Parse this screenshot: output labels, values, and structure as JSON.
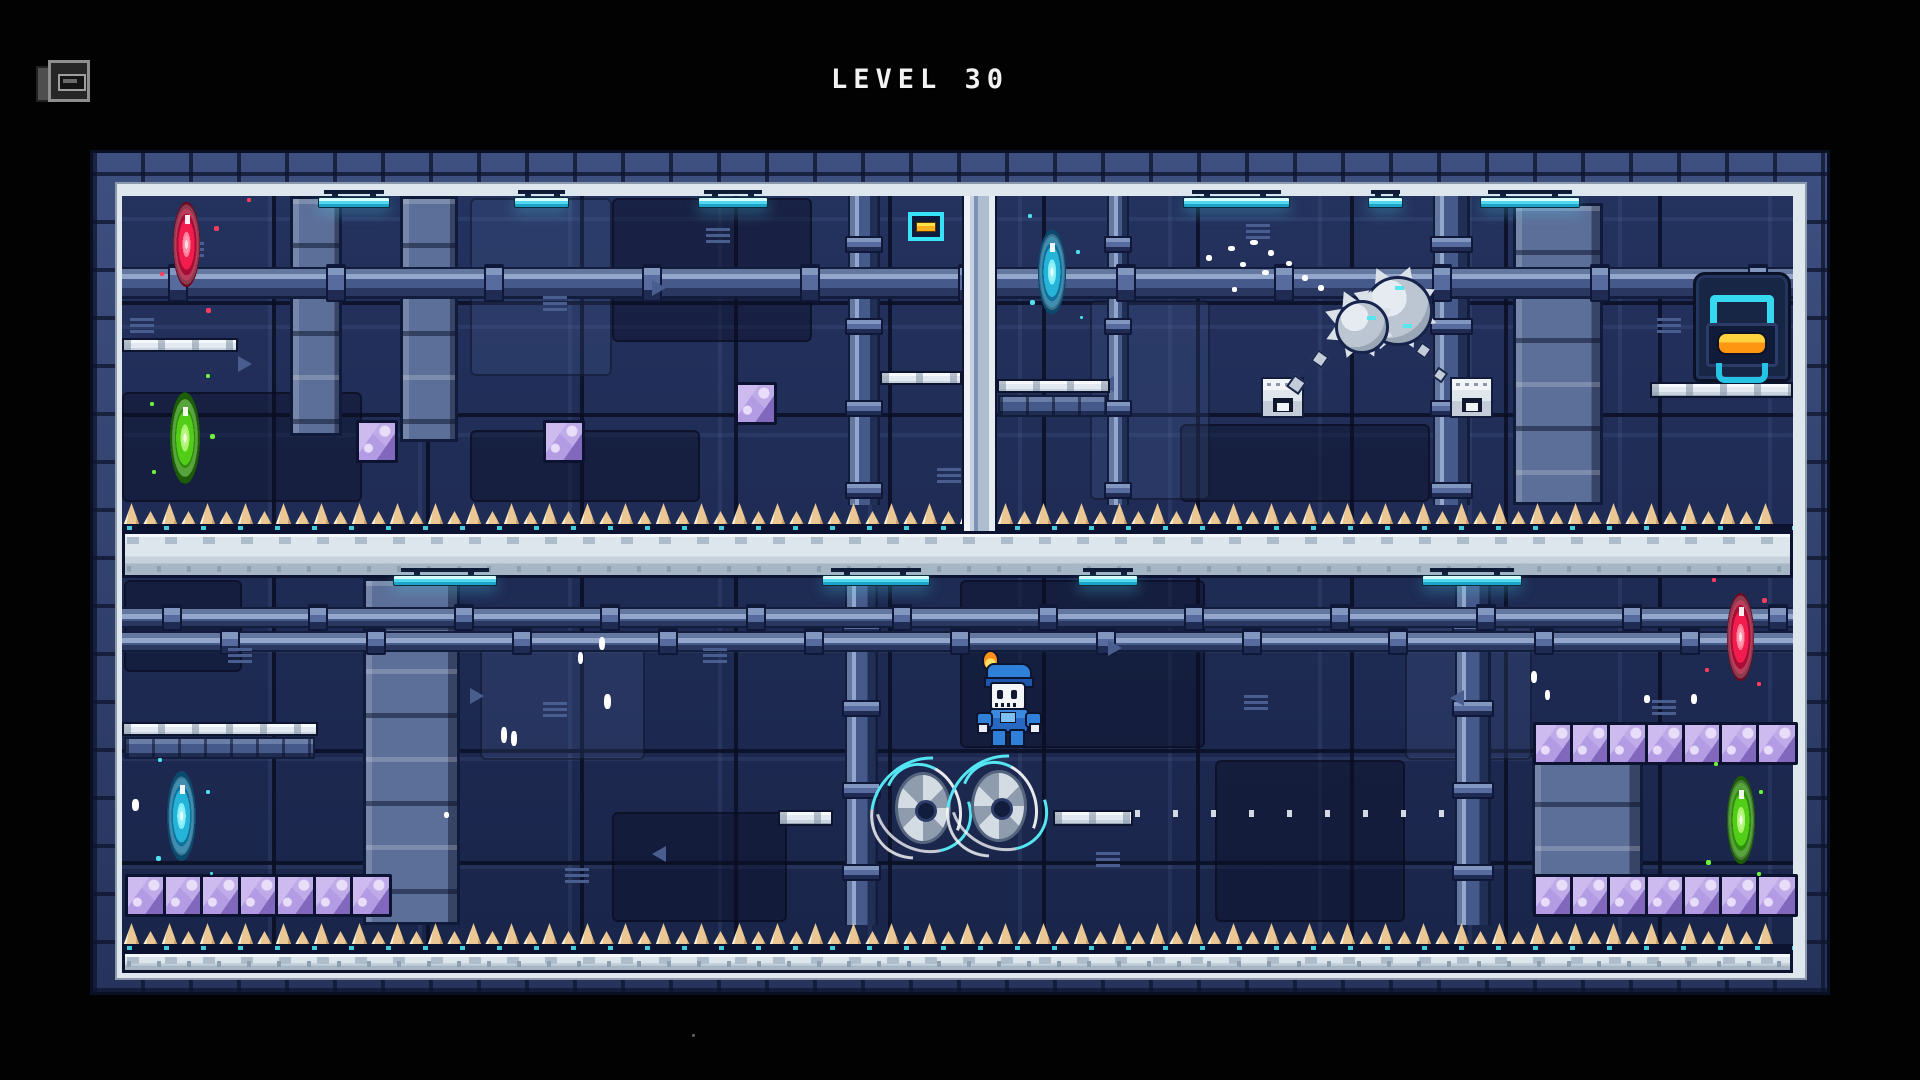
{
  "hud": {
    "level_label": "LEVEL 30",
    "level_number": "30",
    "menu_icon": "camera-icon",
    "title_color": "#f2f2f2"
  },
  "palette": {
    "background": "#020203",
    "wall": "#1e2b55",
    "frame_band": "#2c3a64",
    "platform_white": "#dfe7ee",
    "spike_tan": "#eac793",
    "crystal_purple": "#ab92da",
    "lamp_cyan": "#52d8ee",
    "door_accent_cyan": "#35d8ee",
    "door_button_orange": "#ff9612"
  },
  "portal_colors": {
    "red": {
      "core": "#ffd9e0",
      "light": "#ff7d97",
      "mid": "#f21c4e",
      "dark": "#a80e35",
      "edge": "#6e0a22"
    },
    "green": {
      "core": "#f2ffd8",
      "light": "#a9f26a",
      "mid": "#53ce18",
      "dark": "#2f8e0c",
      "edge": "#1c5c06"
    },
    "cyan": {
      "core": "#e2fcff",
      "light": "#7deef8",
      "mid": "#25b4d8",
      "dark": "#10719c",
      "edge": "#0a4a6e"
    }
  },
  "frame": {
    "x": 90,
    "y": 150,
    "w": 1740,
    "h": 845,
    "inner": {
      "x": 122,
      "y": 196,
      "w": 1671,
      "h": 777
    }
  },
  "entities": [
    {
      "t": "panelD",
      "n": "wall-panel-dark",
      "x": 122,
      "y": 392,
      "w": 240,
      "h": 110
    },
    {
      "t": "panelD",
      "n": "wall-panel-dark",
      "x": 612,
      "y": 198,
      "w": 200,
      "h": 144
    },
    {
      "t": "panelD",
      "n": "wall-panel-dark",
      "x": 1180,
      "y": 424,
      "w": 250,
      "h": 78
    },
    {
      "t": "panelD",
      "n": "wall-panel-dark",
      "x": 470,
      "y": 430,
      "w": 230,
      "h": 72
    },
    {
      "t": "panelD",
      "n": "wall-panel-dark",
      "x": 960,
      "y": 580,
      "w": 245,
      "h": 168
    },
    {
      "t": "panelD",
      "n": "wall-panel-dark",
      "x": 1215,
      "y": 760,
      "w": 190,
      "h": 162
    },
    {
      "t": "panelD",
      "n": "wall-panel-dark",
      "x": 612,
      "y": 812,
      "w": 175,
      "h": 110
    },
    {
      "t": "panelD",
      "n": "wall-panel-dark",
      "x": 124,
      "y": 580,
      "w": 118,
      "h": 92
    },
    {
      "t": "panelL",
      "n": "wall-panel-light",
      "x": 470,
      "y": 198,
      "w": 142,
      "h": 178
    },
    {
      "t": "panelL",
      "n": "wall-panel-light",
      "x": 1090,
      "y": 300,
      "w": 120,
      "h": 200
    },
    {
      "t": "panelL",
      "n": "wall-panel-light",
      "x": 480,
      "y": 640,
      "w": 165,
      "h": 120
    },
    {
      "t": "panelL",
      "n": "wall-panel-light",
      "x": 1405,
      "y": 620,
      "w": 127,
      "h": 140
    },
    {
      "t": "cab",
      "n": "machine-cabinet",
      "x": 290,
      "y": 196,
      "w": 52,
      "h": 240
    },
    {
      "t": "cab",
      "n": "machine-cabinet",
      "x": 400,
      "y": 196,
      "w": 58,
      "h": 246
    },
    {
      "t": "cab",
      "n": "machine-cabinet",
      "x": 1513,
      "y": 203,
      "w": 90,
      "h": 302
    },
    {
      "t": "cab",
      "n": "machine-cabinet",
      "x": 363,
      "y": 578,
      "w": 97,
      "h": 347
    },
    {
      "t": "cab",
      "n": "machine-cabinet",
      "x": 1532,
      "y": 755,
      "w": 111,
      "h": 158
    },
    {
      "t": "pipeV",
      "n": "vertical-pipe",
      "x": 848,
      "y": 196,
      "w": 32,
      "h": 309
    },
    {
      "t": "pipeV",
      "n": "vertical-pipe",
      "x": 1107,
      "y": 196,
      "w": 22,
      "h": 309
    },
    {
      "t": "pipeV",
      "n": "vertical-pipe",
      "x": 1433,
      "y": 196,
      "w": 37,
      "h": 309
    },
    {
      "t": "pipeV",
      "n": "vertical-pipe",
      "x": 845,
      "y": 578,
      "w": 33,
      "h": 347
    },
    {
      "t": "pipeV",
      "n": "vertical-pipe",
      "x": 1455,
      "y": 578,
      "w": 36,
      "h": 347
    },
    {
      "t": "pipeH",
      "n": "horizontal-pipe",
      "x": 122,
      "y": 267,
      "w": 1671,
      "h": 32,
      "step": 158,
      "off": 46
    },
    {
      "t": "pipeH",
      "n": "horizontal-pipe",
      "x": 122,
      "y": 607,
      "w": 1671,
      "h": 21,
      "step": 146,
      "off": 40
    },
    {
      "t": "pipeH",
      "n": "horizontal-pipe",
      "x": 122,
      "y": 631,
      "w": 1671,
      "h": 21,
      "step": 146,
      "off": 98
    },
    {
      "t": "vent",
      "n": "wall-vent",
      "x": 180,
      "y": 242
    },
    {
      "t": "vent",
      "n": "wall-vent",
      "x": 543,
      "y": 296
    },
    {
      "t": "vent",
      "n": "wall-vent",
      "x": 706,
      "y": 228
    },
    {
      "t": "vent",
      "n": "wall-vent",
      "x": 1246,
      "y": 224
    },
    {
      "t": "vent",
      "n": "wall-vent",
      "x": 1657,
      "y": 318
    },
    {
      "t": "vent",
      "n": "wall-vent",
      "x": 937,
      "y": 468
    },
    {
      "t": "vent",
      "n": "wall-vent",
      "x": 543,
      "y": 702
    },
    {
      "t": "vent",
      "n": "wall-vent",
      "x": 703,
      "y": 648
    },
    {
      "t": "vent",
      "n": "wall-vent",
      "x": 1244,
      "y": 695
    },
    {
      "t": "vent",
      "n": "wall-vent",
      "x": 1652,
      "y": 700
    },
    {
      "t": "vent",
      "n": "wall-vent",
      "x": 565,
      "y": 868
    },
    {
      "t": "vent",
      "n": "wall-vent",
      "x": 1096,
      "y": 852
    },
    {
      "t": "vent",
      "n": "wall-vent",
      "x": 228,
      "y": 648
    },
    {
      "t": "vent",
      "n": "wall-vent",
      "x": 130,
      "y": 318
    },
    {
      "t": "arr",
      "n": "wall-arrow",
      "x": 238,
      "y": 356,
      "d": 1
    },
    {
      "t": "arr",
      "n": "wall-arrow",
      "x": 652,
      "y": 280,
      "d": 1
    },
    {
      "t": "arr",
      "n": "wall-arrow",
      "x": 1100,
      "y": 376,
      "d": -1
    },
    {
      "t": "arr",
      "n": "wall-arrow",
      "x": 470,
      "y": 688,
      "d": 1
    },
    {
      "t": "arr",
      "n": "wall-arrow",
      "x": 652,
      "y": 846,
      "d": -1
    },
    {
      "t": "arr",
      "n": "wall-arrow",
      "x": 1108,
      "y": 640,
      "d": 1
    },
    {
      "t": "arr",
      "n": "wall-arrow",
      "x": 1450,
      "y": 690,
      "d": -1
    },
    {
      "t": "duct",
      "n": "wall-duct",
      "x": 998,
      "y": 395,
      "w": 109,
      "h": 22
    },
    {
      "t": "duct",
      "n": "wall-duct",
      "x": 124,
      "y": 737,
      "w": 191,
      "h": 22
    },
    {
      "t": "rivets",
      "n": "wall-rivet-strip",
      "x": 1135,
      "y": 810,
      "w": 322,
      "h": 7
    },
    {
      "t": "ledge",
      "n": "upper-left-ledge",
      "x": 122,
      "y": 338,
      "w": 116,
      "h": 14
    },
    {
      "t": "ledge",
      "n": "pole-left-ledge",
      "x": 880,
      "y": 371,
      "w": 82,
      "h": 14
    },
    {
      "t": "ledge",
      "n": "pole-right-ledge",
      "x": 997,
      "y": 379,
      "w": 113,
      "h": 14
    },
    {
      "t": "ledge",
      "n": "door-ledge",
      "x": 1650,
      "y": 382,
      "w": 143,
      "h": 16
    },
    {
      "t": "ledge",
      "n": "lower-left-ledge",
      "x": 122,
      "y": 722,
      "w": 196,
      "h": 14
    },
    {
      "t": "ledge",
      "n": "saw-left-platform",
      "x": 778,
      "y": 810,
      "w": 55,
      "h": 16
    },
    {
      "t": "ledge",
      "n": "saw-right-platform",
      "x": 1053,
      "y": 810,
      "w": 80,
      "h": 16
    },
    {
      "t": "beam",
      "n": "divider-beam",
      "x": 122,
      "y": 531,
      "w": 1671,
      "h": 47
    },
    {
      "t": "beam",
      "n": "floor-beam",
      "x": 122,
      "y": 951,
      "w": 1671,
      "h": 22
    },
    {
      "t": "spikes",
      "n": "upper-room-floor-spikes",
      "x": 122,
      "y": 505,
      "w": 1671
    },
    {
      "t": "spikes",
      "n": "lower-room-floor-spikes",
      "x": 122,
      "y": 925,
      "w": 1671
    },
    {
      "t": "pole",
      "n": "white-pole",
      "x": 962,
      "y": 196,
      "w": 35,
      "h": 335
    },
    {
      "t": "lamp",
      "n": "ceiling-lamp",
      "x": 318,
      "y": 190,
      "w": 72
    },
    {
      "t": "lamp",
      "n": "ceiling-lamp",
      "x": 514,
      "y": 190,
      "w": 55
    },
    {
      "t": "lamp",
      "n": "ceiling-lamp",
      "x": 698,
      "y": 190,
      "w": 70
    },
    {
      "t": "lamp",
      "n": "ceiling-lamp",
      "x": 1183,
      "y": 190,
      "w": 107
    },
    {
      "t": "lamp",
      "n": "ceiling-lamp",
      "x": 1368,
      "y": 190,
      "w": 35
    },
    {
      "t": "lamp",
      "n": "ceiling-lamp",
      "x": 1480,
      "y": 190,
      "w": 100
    },
    {
      "t": "lamp",
      "n": "ceiling-lamp",
      "x": 393,
      "y": 568,
      "w": 104
    },
    {
      "t": "lamp",
      "n": "ceiling-lamp",
      "x": 822,
      "y": 568,
      "w": 108
    },
    {
      "t": "lamp",
      "n": "ceiling-lamp",
      "x": 1078,
      "y": 568,
      "w": 60
    },
    {
      "t": "lamp",
      "n": "ceiling-lamp",
      "x": 1422,
      "y": 568,
      "w": 100
    },
    {
      "t": "sign",
      "n": "switch-sign",
      "x": 908,
      "y": 212,
      "w": 36,
      "h": 29
    },
    {
      "t": "door",
      "n": "exit-door",
      "x": 1693,
      "y": 272,
      "w": 98,
      "h": 110
    },
    {
      "t": "portal",
      "n": "portal-red-upper-left",
      "c": "red",
      "x": 171,
      "y": 196,
      "w": 31,
      "h": 97
    },
    {
      "t": "portal",
      "n": "portal-green-upper-left",
      "c": "green",
      "x": 168,
      "y": 386,
      "w": 34,
      "h": 104
    },
    {
      "t": "portal",
      "n": "portal-cyan-upper-middle",
      "c": "cyan",
      "x": 1036,
      "y": 224,
      "w": 32,
      "h": 96
    },
    {
      "t": "portal",
      "n": "portal-cyan-lower-left",
      "c": "cyan",
      "x": 165,
      "y": 765,
      "w": 33,
      "h": 102
    },
    {
      "t": "portal",
      "n": "portal-red-lower-right",
      "c": "red",
      "x": 1725,
      "y": 587,
      "w": 31,
      "h": 100
    },
    {
      "t": "portal",
      "n": "portal-green-lower-right",
      "c": "green",
      "x": 1725,
      "y": 770,
      "w": 32,
      "h": 100
    },
    {
      "t": "crystalRow",
      "n": "crystal-block",
      "x": 356,
      "y": 420,
      "count": 1,
      "step": 37.5
    },
    {
      "t": "crystalRow",
      "n": "crystal-block",
      "x": 543,
      "y": 420,
      "count": 1,
      "step": 37.5
    },
    {
      "t": "crystalRow",
      "n": "crystal-block",
      "x": 735,
      "y": 382,
      "count": 1,
      "step": 37.5
    },
    {
      "t": "crystalRow",
      "n": "crystal-row-lower-left",
      "x": 125,
      "y": 874,
      "count": 7,
      "step": 37.5
    },
    {
      "t": "crystalRow",
      "n": "crystal-row-lower-right-top",
      "x": 1533,
      "y": 722,
      "count": 7,
      "step": 37.2
    },
    {
      "t": "crystalRow",
      "n": "crystal-row-lower-right-bottom",
      "x": 1533,
      "y": 874,
      "count": 7,
      "step": 37.2
    },
    {
      "t": "disp",
      "n": "block-dispenser",
      "x": 1261,
      "y": 377,
      "w": 43,
      "h": 41
    },
    {
      "t": "disp",
      "n": "block-dispenser",
      "x": 1450,
      "y": 377,
      "w": 43,
      "h": 41
    },
    {
      "t": "deb",
      "n": "debris-chunk",
      "x": 1313,
      "y": 352,
      "w": 14,
      "h": 14
    },
    {
      "t": "deb",
      "n": "debris-chunk",
      "x": 1417,
      "y": 344,
      "w": 13,
      "h": 13
    },
    {
      "t": "deb",
      "n": "debris-chunk",
      "x": 1434,
      "y": 369,
      "w": 12,
      "h": 12
    },
    {
      "t": "deb",
      "n": "debris-chunk",
      "x": 1289,
      "y": 377,
      "w": 15,
      "h": 15
    },
    {
      "t": "ball",
      "n": "spiked-ball",
      "x": 1333,
      "y": 276,
      "w": 100,
      "h": 86
    },
    {
      "t": "saw",
      "n": "saw-blade-left",
      "x": 887,
      "y": 764,
      "w": 72,
      "h": 88
    },
    {
      "t": "saw",
      "n": "saw-blade-right",
      "x": 963,
      "y": 762,
      "w": 72,
      "h": 88
    },
    {
      "t": "player",
      "n": "player-character",
      "x": 976,
      "y": 650,
      "w": 62,
      "h": 95
    },
    {
      "t": "pt",
      "n": "dust-particle",
      "x": 1206,
      "y": 255,
      "w": 6,
      "h": 6,
      "c": "#ffffff"
    },
    {
      "t": "pt",
      "n": "dust-particle",
      "x": 1228,
      "y": 246,
      "w": 7,
      "h": 5,
      "c": "#ffffff"
    },
    {
      "t": "pt",
      "n": "dust-particle",
      "x": 1250,
      "y": 240,
      "w": 8,
      "h": 5,
      "c": "#ffffff"
    },
    {
      "t": "pt",
      "n": "dust-particle",
      "x": 1268,
      "y": 250,
      "w": 6,
      "h": 6,
      "c": "#ffffff"
    },
    {
      "t": "pt",
      "n": "dust-particle",
      "x": 1240,
      "y": 262,
      "w": 6,
      "h": 5,
      "c": "#ffffff"
    },
    {
      "t": "pt",
      "n": "dust-particle",
      "x": 1262,
      "y": 270,
      "w": 7,
      "h": 5,
      "c": "#ffffff"
    },
    {
      "t": "pt",
      "n": "dust-particle",
      "x": 1286,
      "y": 261,
      "w": 6,
      "h": 5,
      "c": "#ffffff"
    },
    {
      "t": "pt",
      "n": "dust-particle",
      "x": 1302,
      "y": 275,
      "w": 6,
      "h": 6,
      "c": "#ffffff"
    },
    {
      "t": "pt",
      "n": "dust-particle",
      "x": 1318,
      "y": 285,
      "w": 6,
      "h": 6,
      "c": "#ffffff"
    },
    {
      "t": "pt",
      "n": "dust-particle",
      "x": 1232,
      "y": 287,
      "w": 5,
      "h": 5,
      "c": "#ffffff"
    },
    {
      "t": "pt",
      "n": "dust-particle",
      "x": 501,
      "y": 727,
      "w": 6,
      "h": 16,
      "c": "#ffffff"
    },
    {
      "t": "pt",
      "n": "dust-particle",
      "x": 511,
      "y": 731,
      "w": 6,
      "h": 15,
      "c": "#ffffff"
    },
    {
      "t": "pt",
      "n": "dust-particle",
      "x": 578,
      "y": 652,
      "w": 5,
      "h": 12,
      "c": "#ffffff"
    },
    {
      "t": "pt",
      "n": "dust-particle",
      "x": 599,
      "y": 637,
      "w": 6,
      "h": 13,
      "c": "#ffffff"
    },
    {
      "t": "pt",
      "n": "dust-particle",
      "x": 604,
      "y": 694,
      "w": 7,
      "h": 15,
      "c": "#ffffff"
    },
    {
      "t": "pt",
      "n": "dust-particle",
      "x": 444,
      "y": 812,
      "w": 5,
      "h": 6,
      "c": "#ffffff"
    },
    {
      "t": "pt",
      "n": "dust-particle",
      "x": 1531,
      "y": 671,
      "w": 6,
      "h": 12,
      "c": "#ffffff"
    },
    {
      "t": "pt",
      "n": "dust-particle",
      "x": 1545,
      "y": 690,
      "w": 5,
      "h": 10,
      "c": "#ffffff"
    },
    {
      "t": "pt",
      "n": "dust-particle",
      "x": 1644,
      "y": 695,
      "w": 6,
      "h": 8,
      "c": "#ffffff"
    },
    {
      "t": "pt",
      "n": "dust-particle",
      "x": 1691,
      "y": 694,
      "w": 6,
      "h": 10,
      "c": "#ffffff"
    },
    {
      "t": "pt",
      "n": "dust-particle",
      "x": 132,
      "y": 799,
      "w": 7,
      "h": 12,
      "c": "#ffffff"
    },
    {
      "t": "pt",
      "n": "spark-red",
      "x": 214,
      "y": 226,
      "w": 5,
      "h": 5,
      "c": "#ff3b5e"
    },
    {
      "t": "pt",
      "n": "spark-red",
      "x": 160,
      "y": 272,
      "w": 4,
      "h": 4,
      "c": "#ff3b5e"
    },
    {
      "t": "pt",
      "n": "spark-red",
      "x": 206,
      "y": 308,
      "w": 5,
      "h": 5,
      "c": "#ff3b5e"
    },
    {
      "t": "pt",
      "n": "spark-red",
      "x": 247,
      "y": 198,
      "w": 4,
      "h": 4,
      "c": "#ff3b5e"
    },
    {
      "t": "pt",
      "n": "spark-green",
      "x": 150,
      "y": 402,
      "w": 4,
      "h": 4,
      "c": "#6ef23c"
    },
    {
      "t": "pt",
      "n": "spark-green",
      "x": 210,
      "y": 434,
      "w": 5,
      "h": 5,
      "c": "#6ef23c"
    },
    {
      "t": "pt",
      "n": "spark-green",
      "x": 152,
      "y": 470,
      "w": 4,
      "h": 4,
      "c": "#6ef23c"
    },
    {
      "t": "pt",
      "n": "spark-green",
      "x": 206,
      "y": 374,
      "w": 4,
      "h": 4,
      "c": "#6ef23c"
    },
    {
      "t": "pt",
      "n": "spark-cyan",
      "x": 1028,
      "y": 214,
      "w": 4,
      "h": 4,
      "c": "#4fe0f2"
    },
    {
      "t": "pt",
      "n": "spark-cyan",
      "x": 1076,
      "y": 250,
      "w": 4,
      "h": 4,
      "c": "#4fe0f2"
    },
    {
      "t": "pt",
      "n": "spark-cyan",
      "x": 1030,
      "y": 300,
      "w": 5,
      "h": 5,
      "c": "#4fe0f2"
    },
    {
      "t": "pt",
      "n": "spark-cyan",
      "x": 1080,
      "y": 316,
      "w": 3,
      "h": 3,
      "c": "#4fe0f2"
    },
    {
      "t": "pt",
      "n": "spark-cyan",
      "x": 158,
      "y": 758,
      "w": 4,
      "h": 4,
      "c": "#4fe0f2"
    },
    {
      "t": "pt",
      "n": "spark-cyan",
      "x": 206,
      "y": 790,
      "w": 4,
      "h": 4,
      "c": "#4fe0f2"
    },
    {
      "t": "pt",
      "n": "spark-cyan",
      "x": 156,
      "y": 856,
      "w": 5,
      "h": 5,
      "c": "#4fe0f2"
    },
    {
      "t": "pt",
      "n": "spark-cyan",
      "x": 210,
      "y": 872,
      "w": 3,
      "h": 3,
      "c": "#4fe0f2"
    },
    {
      "t": "pt",
      "n": "spark-red",
      "x": 1712,
      "y": 578,
      "w": 4,
      "h": 4,
      "c": "#ff3b5e"
    },
    {
      "t": "pt",
      "n": "spark-red",
      "x": 1762,
      "y": 598,
      "w": 5,
      "h": 5,
      "c": "#ff3b5e"
    },
    {
      "t": "pt",
      "n": "spark-red",
      "x": 1705,
      "y": 668,
      "w": 4,
      "h": 4,
      "c": "#ff3b5e"
    },
    {
      "t": "pt",
      "n": "spark-red",
      "x": 1757,
      "y": 682,
      "w": 4,
      "h": 4,
      "c": "#ff3b5e"
    },
    {
      "t": "pt",
      "n": "spark-green",
      "x": 1714,
      "y": 762,
      "w": 4,
      "h": 4,
      "c": "#6ef23c"
    },
    {
      "t": "pt",
      "n": "spark-green",
      "x": 1759,
      "y": 790,
      "w": 4,
      "h": 4,
      "c": "#6ef23c"
    },
    {
      "t": "pt",
      "n": "spark-green",
      "x": 1706,
      "y": 860,
      "w": 5,
      "h": 5,
      "c": "#6ef23c"
    },
    {
      "t": "pt",
      "n": "spark-green",
      "x": 1757,
      "y": 872,
      "w": 4,
      "h": 4,
      "c": "#6ef23c"
    },
    {
      "t": "pt",
      "n": "stray-dot",
      "x": 692,
      "y": 1034,
      "w": 3,
      "h": 3,
      "c": "#606060"
    }
  ]
}
